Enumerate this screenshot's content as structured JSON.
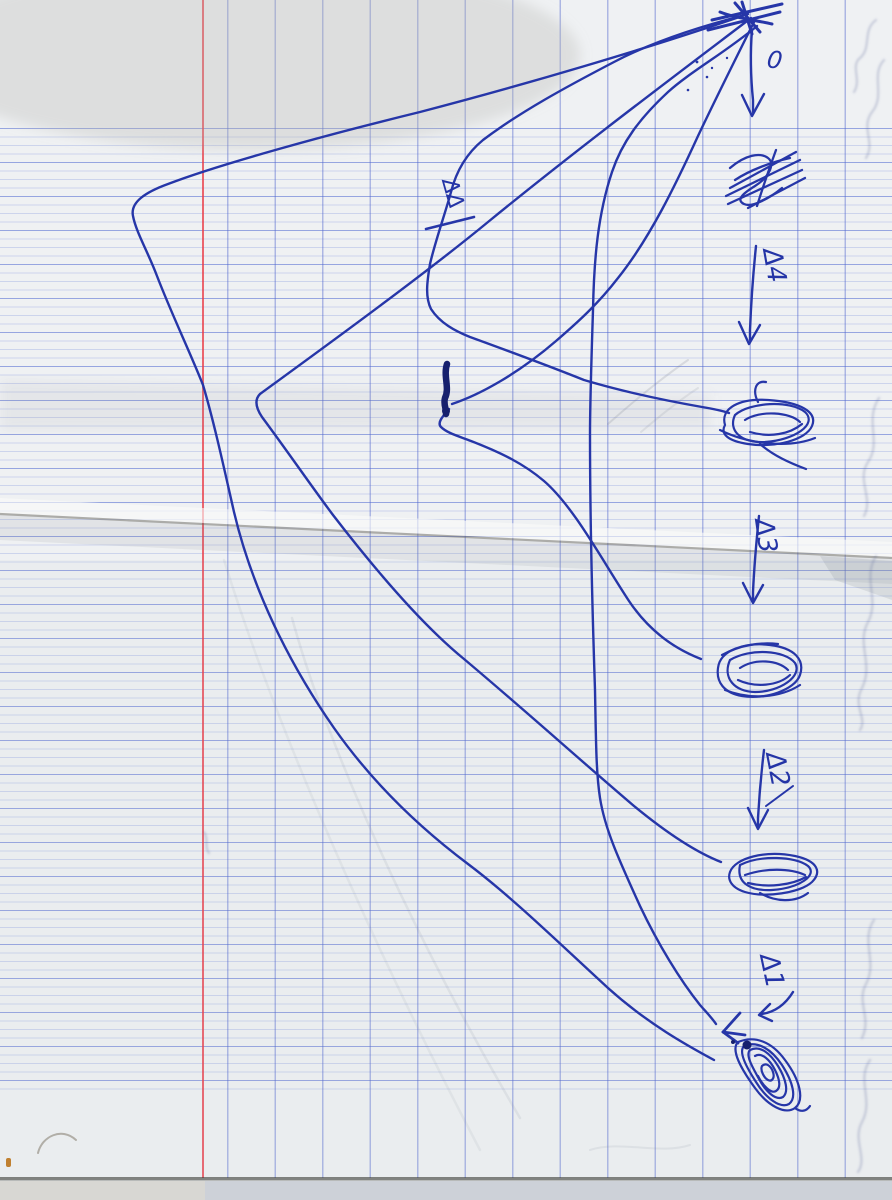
{
  "document": {
    "kind": "scanned handwritten ball-pen sketch",
    "paper": "squared (Séyès) notebook page with red margin and horizontal fold crease"
  },
  "labels": {
    "zero": "0",
    "delta_4": "Δ4",
    "delta_3": "Δ3",
    "delta_2": "Δ2",
    "delta_1": "Δ1",
    "double_delta": "ΔΔ"
  },
  "sketch": {
    "origin": "lines fan out from a convergence point at top-right",
    "node_count": 4,
    "arrow_column_labels": [
      "0",
      "Δ4",
      "Δ3",
      "Δ2",
      "Δ1"
    ],
    "scribbled_word_crossed_out": true
  },
  "colors": {
    "ink": "#2535a6",
    "grid_blue": "#8096d2",
    "margin_red": "#e0454e",
    "paper": "#eef0f2"
  }
}
